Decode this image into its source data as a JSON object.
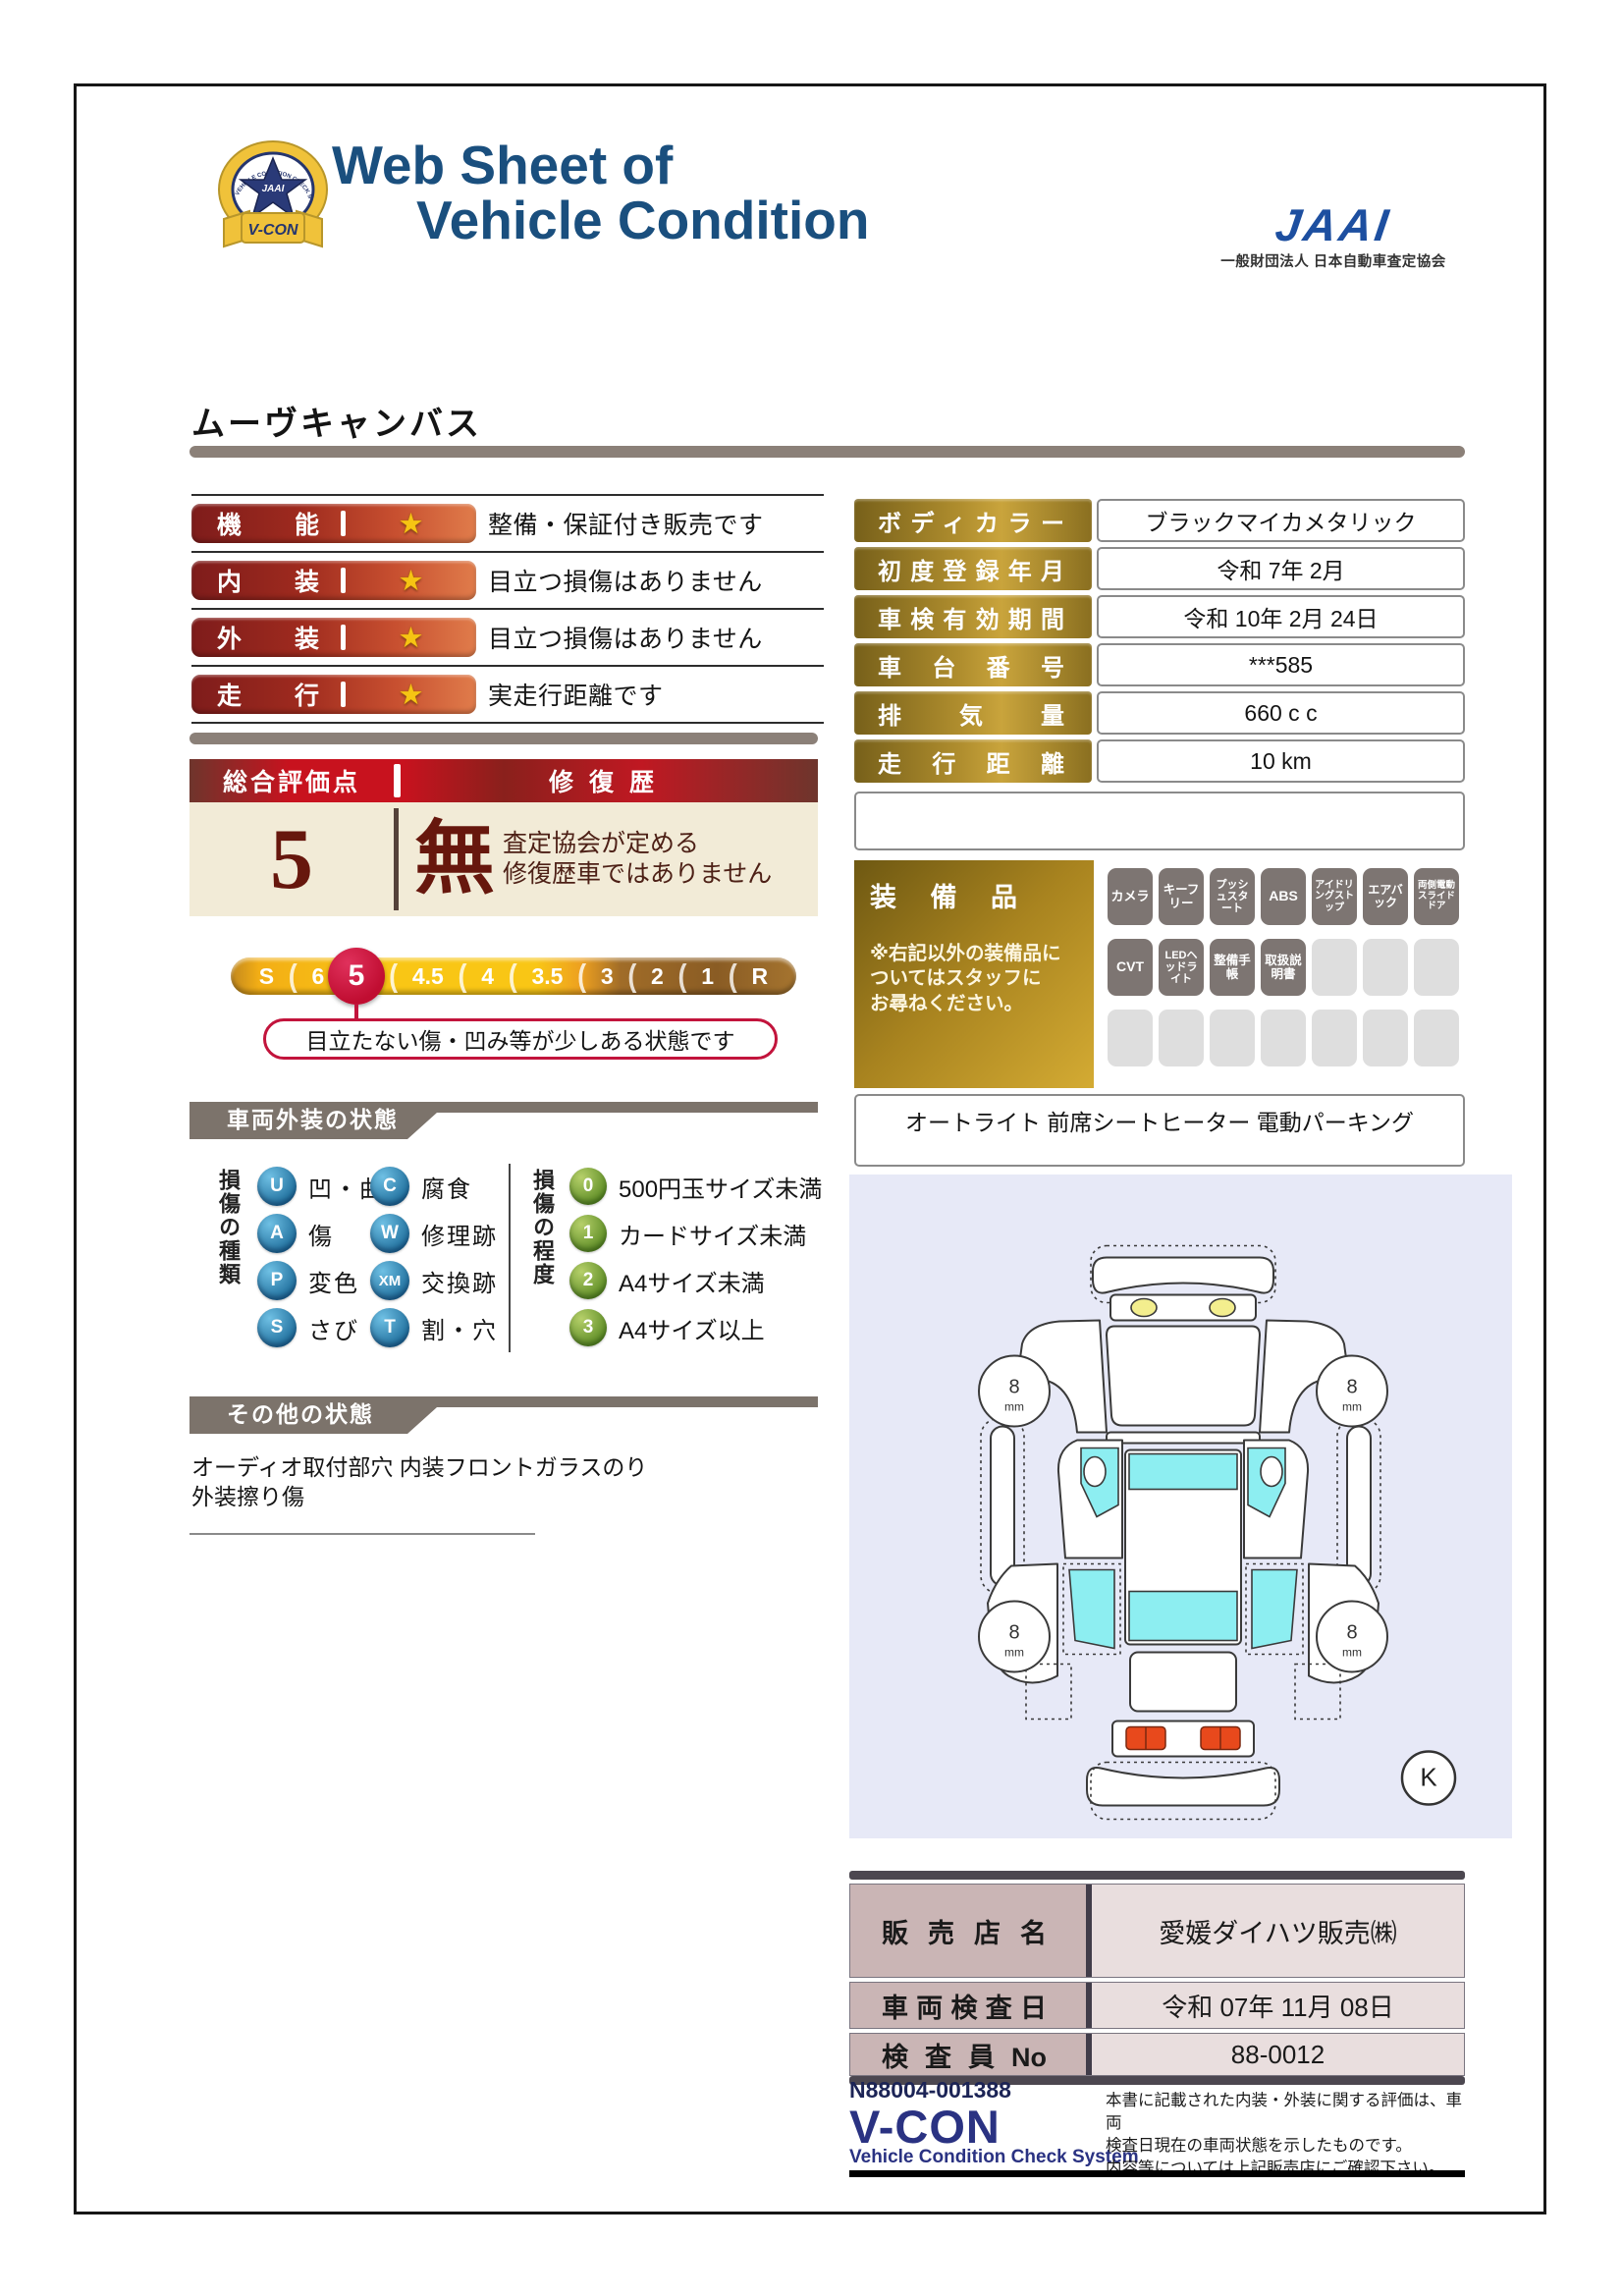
{
  "header": {
    "title_line1": "Web Sheet of",
    "title_line2": "Vehicle Condition",
    "badge": {
      "arc": "VEHICLE CONDITION CHECK SYSTEM",
      "monogram": "JAAI",
      "ribbon": "V-CON"
    },
    "jaai_logo": "JAAI",
    "jaai_subtitle": "一般財団法人 日本自動車査定協会"
  },
  "vehicle_name": "ムーヴキャンバス",
  "ratings": {
    "star_glyph": "★",
    "rows": [
      {
        "label": "機能",
        "description": "整備・保証付き販売です"
      },
      {
        "label": "内装",
        "description": "目立つ損傷はありません"
      },
      {
        "label": "外装",
        "description": "目立つ損傷はありません"
      },
      {
        "label": "走行",
        "description": "実走行距離です"
      }
    ]
  },
  "details": {
    "rows": [
      {
        "label": "ボディカラー",
        "value": "ブラックマイカメタリック"
      },
      {
        "label": "初度登録年月",
        "value": "令和 7年 2月"
      },
      {
        "label": "車検有効期間",
        "value": "令和 10年 2月 24日"
      },
      {
        "label": "車台番号",
        "value": "***585"
      },
      {
        "label": "排気量",
        "value": "660 c c"
      },
      {
        "label": "走行距離",
        "value": "10 km"
      }
    ]
  },
  "score": {
    "header_left": "総合評価点",
    "header_right": "修復歴",
    "value": "5",
    "repair_flag": "無",
    "repair_note_line1": "査定協会が定める",
    "repair_note_line2": "修復歴車ではありません",
    "callout": "目立たない傷・凹み等が少しある状態です",
    "scale": {
      "separator": "(",
      "selected": "5",
      "items": [
        "S",
        "6",
        "5",
        "4.5",
        "4",
        "3.5",
        "3",
        "2",
        "1",
        "R"
      ]
    }
  },
  "exterior": {
    "section_title": "車両外装の状態",
    "type_label": "損傷の種類",
    "types": [
      {
        "code": "U",
        "label": "凹・曲"
      },
      {
        "code": "A",
        "label": "傷"
      },
      {
        "code": "P",
        "label": "変色"
      },
      {
        "code": "S",
        "label": "さび"
      },
      {
        "code": "C",
        "label": "腐食"
      },
      {
        "code": "W",
        "label": "修理跡"
      },
      {
        "code": "XM",
        "label": "交換跡"
      },
      {
        "code": "T",
        "label": "割・穴"
      }
    ],
    "degree_label": "損傷の程度",
    "degrees": [
      {
        "code": "0",
        "label": "500円玉サイズ未満"
      },
      {
        "code": "1",
        "label": "カードサイズ未満"
      },
      {
        "code": "2",
        "label": "A4サイズ未満"
      },
      {
        "code": "3",
        "label": "A4サイズ以上"
      }
    ]
  },
  "other": {
    "section_title": "その他の状態",
    "text": "オーディオ取付部穴 内装フロントガラスのり\n外装擦り傷"
  },
  "equipment": {
    "label": "装備品",
    "note": "※右記以外の装備品に\nついてはスタッフに\nお尋ねください。",
    "active": [
      "カメラ",
      "キーフリー",
      "プッシュスタート",
      "ABS",
      "アイドリングストップ",
      "エアバック",
      "両側電動スライドドア",
      "CVT",
      "LEDヘッドライト",
      "整備手帳",
      "取扱説明書"
    ],
    "extra": "オートライト 前席シートヒーター 電動パーキング"
  },
  "diagram": {
    "tire_depth": "8",
    "tire_unit": "mm",
    "marker": "K"
  },
  "dealer": {
    "rows": [
      {
        "label": "販売店名",
        "value": "愛媛ダイハツ販売㈱"
      },
      {
        "label": "車両検査日",
        "value": "令和 07年 11月 08日"
      },
      {
        "label": "検査員No",
        "value": "88-0012"
      }
    ]
  },
  "footer": {
    "serial": "N88004-001388",
    "vcon": "V-CON",
    "vcon_sub": "Vehicle Condition Check System",
    "note": "本書に記載された内装・外装に関する評価は、車両\n検査日現在の車両状態を示したものです。\n内容等については上記販売店にご確認下さい。"
  },
  "colors": {
    "title_navy": "#1a4f7e",
    "jaai_blue": "#1d4fa0",
    "rating_red_dark": "#7e1c1b",
    "rating_orange": "#e07c4b",
    "gold_dark": "#77601a",
    "gold_light": "#c9a43c",
    "score_red": "#c8121e",
    "score_cream": "#f2ebd7",
    "score_text": "#67170d",
    "scale_gold": "#f9c615",
    "scale_selected": "#c00d31",
    "section_gray": "#7c736b",
    "legend_blue": "#1f6e9c",
    "legend_green": "#5d8c25",
    "diagram_bg": "#e7e9f7",
    "window_cyan": "#8deef1",
    "dealer_label_pink": "#cab5b5",
    "dealer_value_pink": "#e9dede",
    "footer_navy": "#2a3282"
  }
}
